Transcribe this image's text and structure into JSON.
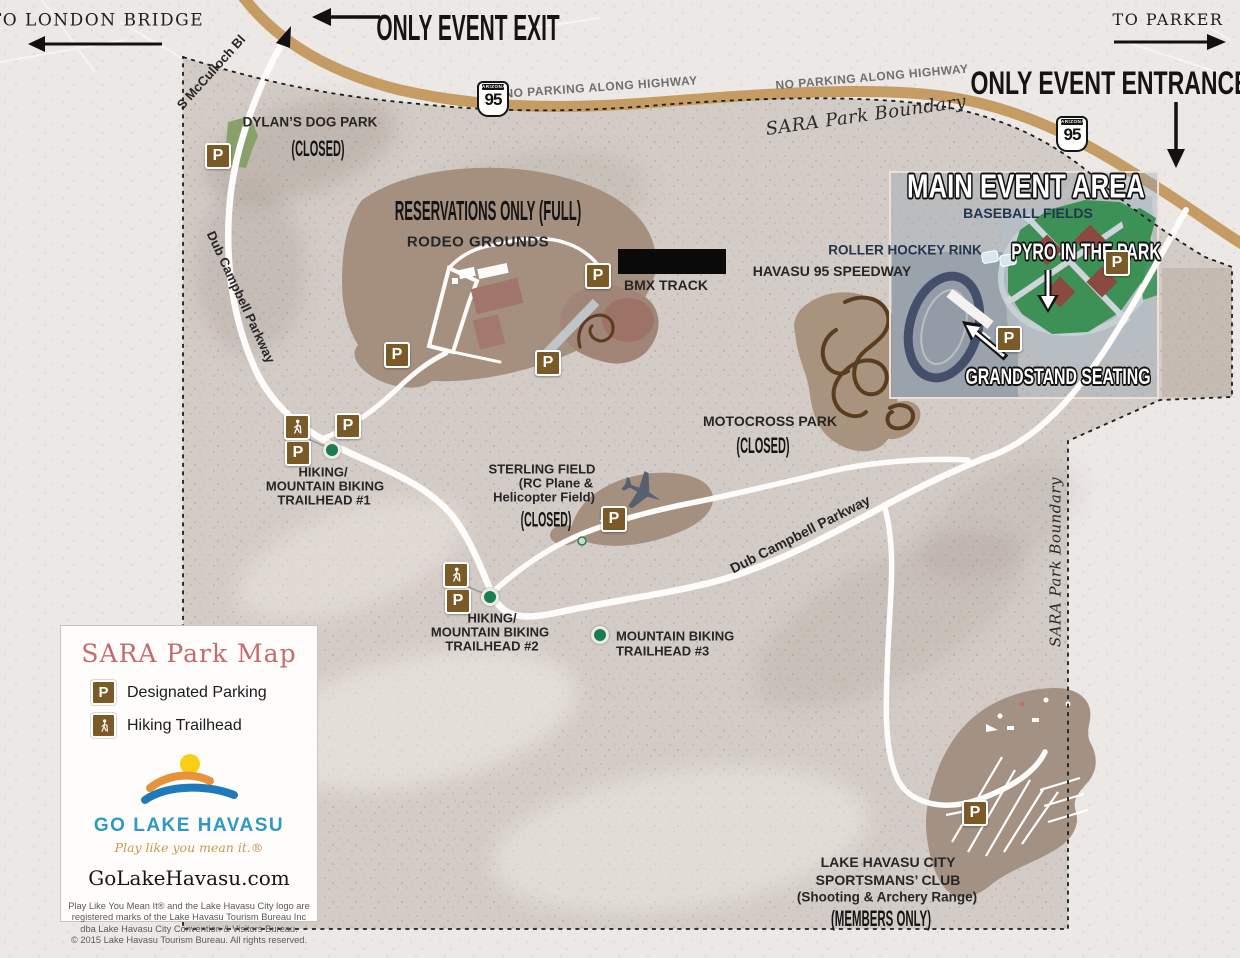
{
  "nav": {
    "to_london_bridge": "TO LONDON BRIDGE",
    "only_event_exit": "ONLY EVENT EXIT",
    "to_parker": "TO PARKER",
    "only_event_entrance": "ONLY EVENT ENTRANCE"
  },
  "highway": {
    "shield_state": "ARIZONA",
    "shield_number": "95",
    "no_parking": "NO PARKING ALONG HIGHWAY",
    "boundary_label": "SARA Park Boundary"
  },
  "roads": {
    "mcculloch": "S McCulloch Bl",
    "dub_campbell": "Dub Campbell Parkway"
  },
  "features": {
    "dog_park": {
      "name": "DYLAN’S DOG PARK",
      "status": "(CLOSED)"
    },
    "rodeo": {
      "note": "RESERVATIONS ONLY (FULL)",
      "name": "RODEO GROUNDS"
    },
    "bmx": {
      "name": "BMX TRACK"
    },
    "speedway": {
      "name": "HAVASU 95 SPEEDWAY"
    },
    "roller_hockey": {
      "name": "ROLLER HOCKEY RINK"
    },
    "main_event": {
      "title": "MAIN EVENT AREA",
      "subtitle": "BASEBALL FIELDS",
      "pyro": "PYRO IN THE PARK",
      "grandstand": "GRANDSTAND SEATING"
    },
    "motocross": {
      "name": "MOTOCROSS PARK",
      "status": "(CLOSED)"
    },
    "sterling": {
      "name": "STERLING FIELD",
      "sub1": "(RC Plane &",
      "sub2": "Helicopter Field)",
      "status": "(CLOSED)"
    },
    "sportsmans": {
      "line1": "LAKE HAVASU CITY",
      "line2": "SPORTSMANS’ CLUB",
      "line3": "(Shooting & Archery Range)",
      "status": "(MEMBERS ONLY)"
    },
    "trailhead1": {
      "line1": "HIKING/",
      "line2": "MOUNTAIN BIKING",
      "line3": "TRAILHEAD #1"
    },
    "trailhead2": {
      "line1": "HIKING/",
      "line2": "MOUNTAIN BIKING",
      "line3": "TRAILHEAD #2"
    },
    "trailhead3": {
      "line1": "MOUNTAIN BIKING",
      "line2": "TRAILHEAD #3"
    }
  },
  "icons": {
    "parking_letter": "P"
  },
  "legend": {
    "title": "SARA Park Map",
    "items": [
      {
        "icon": "parking-icon",
        "label": "Designated Parking"
      },
      {
        "icon": "hiking-trailhead-icon",
        "label": "Hiking Trailhead"
      }
    ],
    "logo_name": "GO LAKE HAVASU",
    "tagline": "Play like you mean it.®",
    "website": "GoLakeHavasu.com",
    "fine_print": [
      "Play Like You Mean It® and the Lake Havasu City logo are",
      "registered marks of the Lake Havasu Tourism Bureau Inc",
      "dba Lake Havasu City Convention & Visitors Bureau.",
      "© 2015 Lake Havasu Tourism Bureau. All rights reserved."
    ]
  },
  "colors": {
    "highway_tan": "#c49c64",
    "parking_brown": "#7a5a26",
    "trailhead_green": "#1b7c4e",
    "legend_title_rose": "#c66a6d",
    "logo_blue": "#2e9ac4",
    "tagline_gold": "#c79a4e",
    "navy_label": "#22354e",
    "park_terrain": "#d3ccc6",
    "facility_brown": "#a5907f"
  }
}
